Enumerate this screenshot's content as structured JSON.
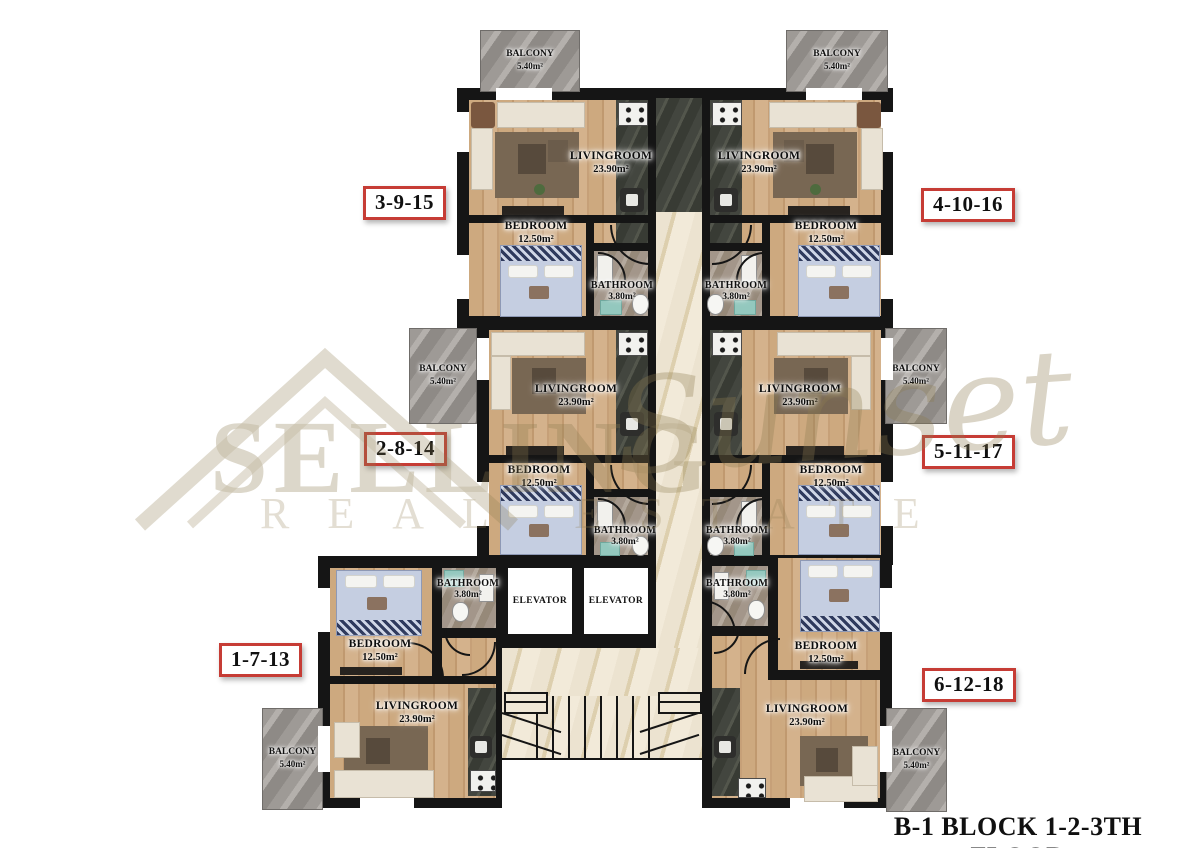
{
  "page": {
    "background": "#ffffff",
    "title": "B-1 BLOCK 1-2-3TH FLOOR"
  },
  "watermark": {
    "word_main": "SELLING",
    "word_script": "Sunset",
    "word_sub": "REAL ESTATE"
  },
  "labels": {
    "livingroom": "LIVINGROOM",
    "livingroom_area": "23.90m²",
    "bedroom": "BEDROOM",
    "bedroom_area": "12.50m²",
    "bathroom": "BATHROOM",
    "bathroom_area": "3.80m²",
    "balcony": "BALCONY",
    "balcony_area": "5.40m²",
    "elevator": "ELEVATOR"
  },
  "units": {
    "top_left": "3-9-15",
    "top_right": "4-10-16",
    "middle_left": "2-8-14",
    "middle_right": "5-11-17",
    "bottom_left": "1-7-13",
    "bottom_right": "6-12-18"
  },
  "colors": {
    "wall": "#151515",
    "wood_floor": "#c9a47f",
    "kitchen_tile": "#43463f",
    "corridor_marble": "#ece3d0",
    "balcony_stone": "#9e9a96",
    "bathroom_floor": "#a3968a",
    "bed_blue": "#c5cee1",
    "bed_navy": "#2f3a5d",
    "unit_tag_border": "#c63c35",
    "watermark_gold": "#8d7c50"
  }
}
